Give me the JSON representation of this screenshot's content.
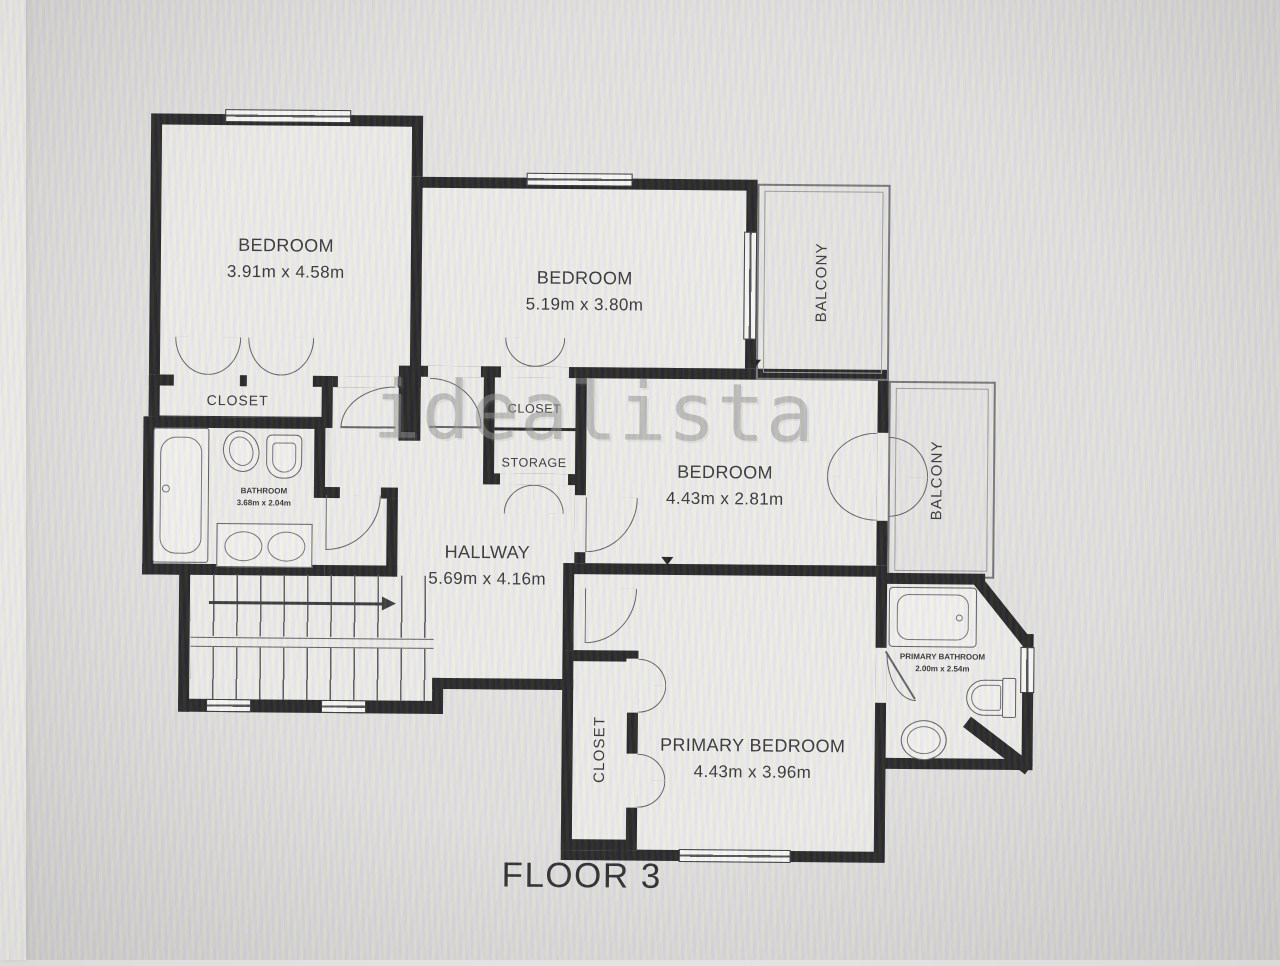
{
  "title": {
    "floor_label": "FLOOR 3"
  },
  "watermark": {
    "text": "idealista"
  },
  "colors": {
    "wall": "#19191b",
    "floor": "#efeeec",
    "background": "#e2e1e0",
    "label": "#2b2b2f",
    "fixture_line": "#55555a",
    "watermark": "#8d8d8d"
  },
  "rooms": {
    "bedroom_top_left": {
      "name": "BEDROOM",
      "dims": "3.91m x 4.58m"
    },
    "bedroom_top_mid": {
      "name": "BEDROOM",
      "dims": "5.19m x 3.80m"
    },
    "bedroom_mid_right": {
      "name": "BEDROOM",
      "dims": "4.43m x 2.81m"
    },
    "primary_bedroom": {
      "name": "PRIMARY BEDROOM",
      "dims": "4.43m x 3.96m"
    },
    "hallway": {
      "name": "HALLWAY",
      "dims": "5.69m x 4.16m"
    },
    "bathroom": {
      "name": "BATHROOM",
      "dims": "3.68m x 2.04m"
    },
    "primary_bathroom": {
      "name": "PRIMARY BATHROOM",
      "dims": "2.00m x 2.54m"
    },
    "closet_left": {
      "name": "CLOSET"
    },
    "closet_mid": {
      "name": "CLOSET"
    },
    "storage": {
      "name": "STORAGE"
    },
    "closet_primary": {
      "name": "CLOSET"
    },
    "balcony_top": {
      "name": "BALCONY"
    },
    "balcony_right": {
      "name": "BALCONY"
    }
  }
}
